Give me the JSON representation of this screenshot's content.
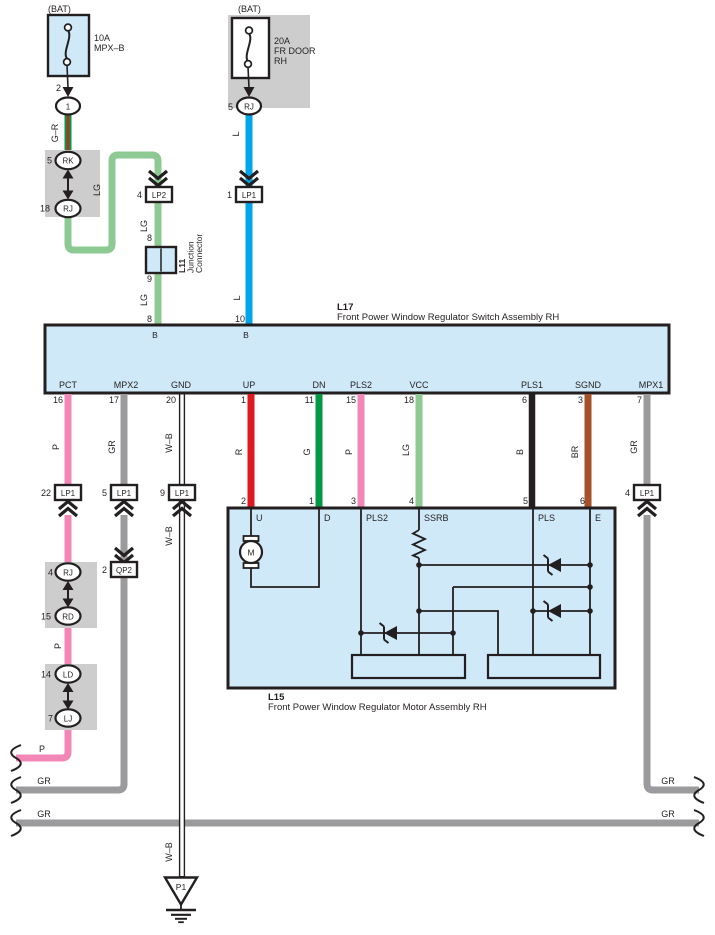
{
  "colors": {
    "outline": "#231f20",
    "box_blue": "#cfe9f8",
    "box_gray": "#cdcdcd",
    "white": "#ffffff",
    "wire_P": "#f287b7",
    "wire_GR": "#9b9b9d",
    "wire_R": "#e0181f",
    "wire_G": "#009a44",
    "wire_LG": "#8cc993",
    "wire_L": "#00a6e9",
    "wire_B": "#231f20",
    "wire_BR": "#a5512a"
  },
  "wire_labels": {
    "g_r": "G–R",
    "lg": "LG",
    "l": "L",
    "p": "P",
    "gr": "GR",
    "wb": "W–B",
    "r": "R",
    "g": "G",
    "b": "B",
    "br": "BR"
  },
  "fuse_left": {
    "bat": "(BAT)",
    "rating": "10A",
    "name": "MPX–B",
    "pin": "2",
    "connector": "1"
  },
  "fuse_right": {
    "bat": "(BAT)",
    "rating": "20A",
    "name_line1": "FR DOOR",
    "name_line2": "RH",
    "pin": "5",
    "connector": "RJ"
  },
  "connector_pair_top": {
    "top_pin": "5",
    "top_label": "RK",
    "bottom_pin": "18",
    "bottom_label": "RJ"
  },
  "lp2": {
    "pin": "4",
    "label": "LP2"
  },
  "lp1_top": {
    "pin": "1",
    "label": "LP1"
  },
  "junction": {
    "code": "L11",
    "name_line1": "Junction",
    "name_line2": "Connector",
    "pin_top": "8",
    "pin_bottom": "9"
  },
  "l17": {
    "code": "L17",
    "name": "Front Power Window Regulator Switch Assembly RH",
    "top_pins": [
      {
        "num": "8",
        "inner": "B"
      },
      {
        "num": "10",
        "inner": "B"
      }
    ],
    "pins": [
      {
        "name": "PCT",
        "num": "16",
        "wire": "P"
      },
      {
        "name": "MPX2",
        "num": "17",
        "wire": "GR"
      },
      {
        "name": "GND",
        "num": "20",
        "wire": "W–B"
      },
      {
        "name": "UP",
        "num": "1",
        "wire": "R"
      },
      {
        "name": "DN",
        "num": "11",
        "wire": "G"
      },
      {
        "name": "PLS2",
        "num": "15",
        "wire": "P"
      },
      {
        "name": "VCC",
        "num": "18",
        "wire": "LG"
      },
      {
        "name": "PLS1",
        "num": "6",
        "wire": "B"
      },
      {
        "name": "SGND",
        "num": "3",
        "wire": "BR"
      },
      {
        "name": "MPX1",
        "num": "7",
        "wire": "GR"
      }
    ]
  },
  "mid_connectors": [
    {
      "pin": "22",
      "label": "LP1"
    },
    {
      "pin": "5",
      "label": "LP1"
    },
    {
      "pin": "9",
      "label": "LP1"
    },
    {
      "pin": "4",
      "label": "LP1"
    }
  ],
  "qp2": {
    "pin": "2",
    "label": "QP2"
  },
  "chain_connectors": [
    {
      "pin": "4",
      "label": "RJ"
    },
    {
      "pin": "15",
      "label": "RD"
    },
    {
      "pin": "14",
      "label": "LD"
    },
    {
      "pin": "7",
      "label": "LJ"
    }
  ],
  "l15": {
    "code": "L15",
    "name": "Front Power Window Regulator Motor Assembly RH",
    "pins": [
      {
        "num": "2",
        "name": "U"
      },
      {
        "num": "1",
        "name": "D"
      },
      {
        "num": "3",
        "name": "PLS2"
      },
      {
        "num": "4",
        "name": "SSRB"
      },
      {
        "num": "5",
        "name": "PLS"
      },
      {
        "num": "6",
        "name": "E"
      }
    ],
    "motor_label": "M"
  },
  "ground": {
    "label": "P1"
  }
}
